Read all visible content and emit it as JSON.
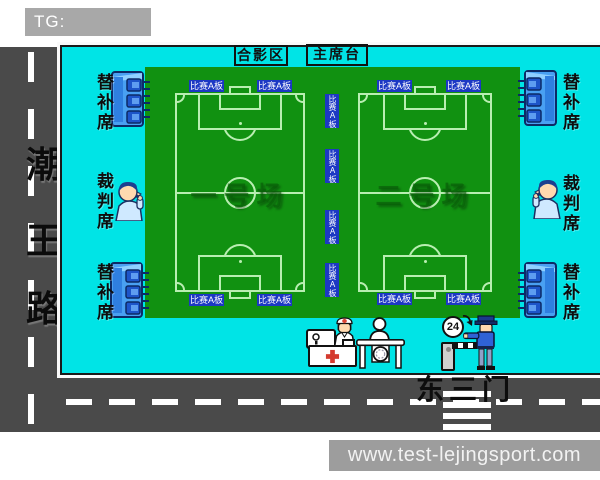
{
  "banner": {
    "text": "TG: MYYJJPP"
  },
  "roads": {
    "west_name_chars": [
      "潮",
      "王",
      "路"
    ],
    "south_gate_label": "东三门"
  },
  "venue": {
    "photo_area_label": "合影区",
    "rostrum_label": "主席台",
    "board_label": "比赛A板",
    "bench_label": "替补席",
    "referee_label": "裁判席",
    "field1_name": "一号场",
    "field2_name": "二号场",
    "gate_hours": "24"
  },
  "watermark": {
    "text": "www.test-lejingsport.com"
  },
  "icons": {
    "bench-icon": "blue dugout shelter with three seats",
    "referee-icon": "cartoon referee blowing whistle",
    "medical-monitor-icon": "signboard on stand",
    "nurse-icon": "nurse with red-cross cap",
    "medical-desk-icon": "white counter with red cross",
    "red-cross-icon": "red plus",
    "receptionist-icon": "person silhouette",
    "reception-table-icon": "table with round emblem",
    "24-hour-sign": "circle with 24 and clockwise arrow",
    "barrier-gate-icon": "striped boom barrier with post",
    "security-guard-icon": "guard in blue uniform"
  },
  "colors": {
    "background_cyan": "#00e4e6",
    "field_green": "#119111",
    "pitch_line": "#b9eeb2",
    "road_gray": "#4a4a4a",
    "board_blue": "#1c38c4",
    "bench_blue": "#49a0f2",
    "banner_gray": "#a8a8a8",
    "watermark_gray": "#9d9d9d"
  }
}
